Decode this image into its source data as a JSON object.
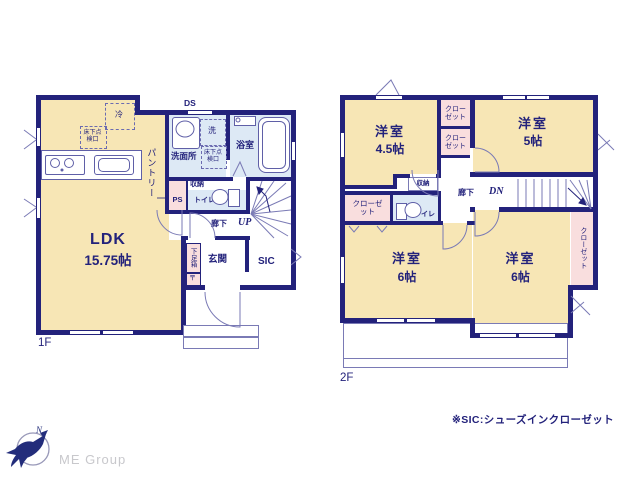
{
  "colors": {
    "wall": "#23227b",
    "cream": "#f7e6b5",
    "pink": "#f9dede",
    "blue": "#dde9f5",
    "line": "#5f5fa7",
    "logo_navy": "#232d7b",
    "logo_gray": "#c8c8cc"
  },
  "floor1": {
    "floor_label": "1F",
    "ldk": {
      "name": "LDK",
      "size": "15.75帖"
    },
    "pantry": "パントリー",
    "fridge": "冷",
    "hatch_ldk": "床下点検口",
    "duct": "DS",
    "washroom": {
      "name": "洗面所",
      "washer": "洗",
      "hatch": "床下点検口"
    },
    "bathroom": {
      "name": "浴室"
    },
    "ps": "PS",
    "storage": "収納",
    "toilet": "トイレ",
    "hallway": "廊下",
    "stairs_up": "UP",
    "entrance": {
      "name": "玄関",
      "shoe_box": "下足箱",
      "shoe_mark": "〒",
      "sic": "SIC"
    }
  },
  "floor2": {
    "floor_label": "2F",
    "room_45": {
      "name": "洋室",
      "size": "4.5帖"
    },
    "room_5": {
      "name": "洋室",
      "size": "5帖"
    },
    "room_6a": {
      "name": "洋室",
      "size": "6帖"
    },
    "room_6b": {
      "name": "洋室",
      "size": "6帖"
    },
    "closet_top1": "クローゼット",
    "closet_top2": "クローゼット",
    "closet_left": "クローゼット",
    "closet_right": "クローゼット",
    "storage": "収納",
    "toilet": "トイレ",
    "hallway": "廊下",
    "stairs_down": "DN"
  },
  "footer": {
    "note": "※SIC:シューズインクローゼット",
    "logo_text": "ME Group",
    "compass_north": "N"
  }
}
